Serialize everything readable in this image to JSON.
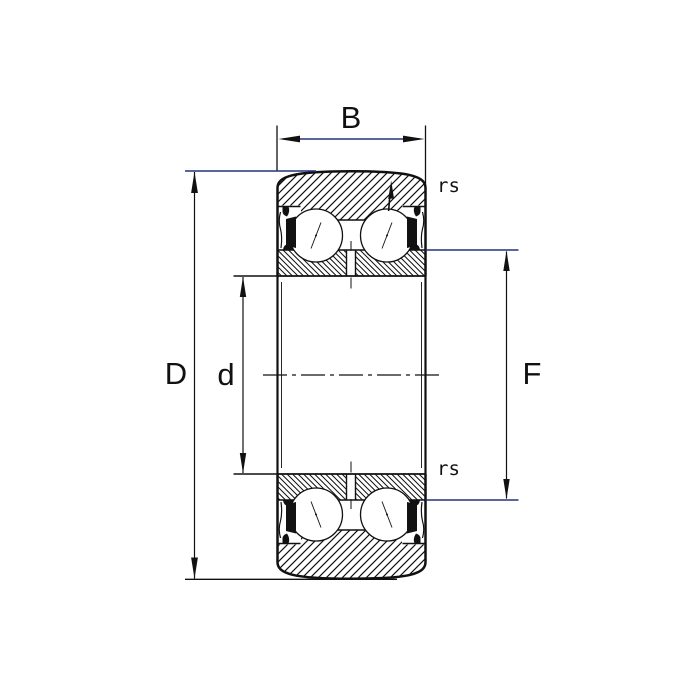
{
  "diagram": {
    "kind": "bearing cross-section technical drawing",
    "labels": {
      "width": "B",
      "outer_diameter": "D",
      "bore_diameter": "d",
      "rib_diameter": "F",
      "corner_radius_top": "rs",
      "corner_radius_bottom": "rs"
    },
    "colors": {
      "ink": "#111111",
      "dim": "#26317b",
      "seal": "#121212",
      "bg": "#ffffff"
    }
  }
}
